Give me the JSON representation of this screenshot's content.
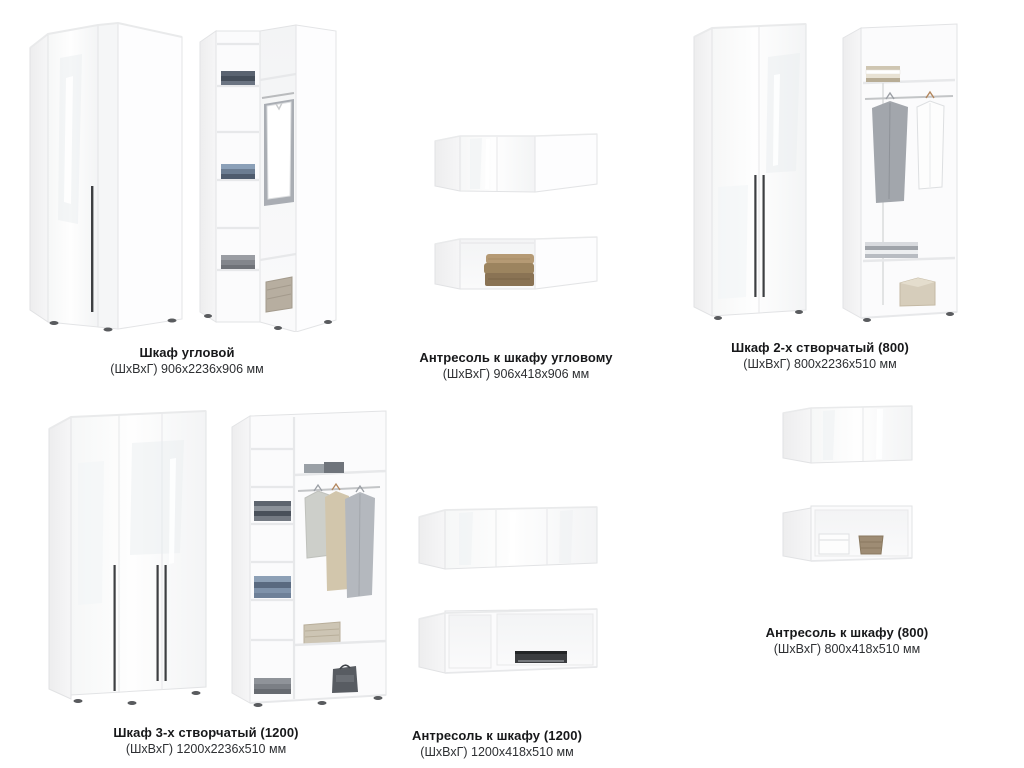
{
  "page": {
    "type": "furniture-catalog-sheet",
    "background_color": "#ffffff",
    "text_color": "#17181a",
    "furniture_color": "#ffffff",
    "handle_color": "#3d3f42"
  },
  "products": [
    {
      "title": "Шкаф угловой",
      "dimensions": "(ШхВхГ) 906х2236х906 мм"
    },
    {
      "title": "Антресоль к шкафу угловому",
      "dimensions": "(ШхВхГ) 906х418х906 мм"
    },
    {
      "title": "Шкаф 2-х створчатый (800)",
      "dimensions": "(ШхВхГ) 800х2236х510 мм"
    },
    {
      "title": "Шкаф 3-х створчатый (1200)",
      "dimensions": "(ШхВхГ) 1200х2236х510 мм"
    },
    {
      "title": "Антресоль к шкафу (1200)",
      "dimensions": "(ШхВхГ) 1200х418х510 мм"
    },
    {
      "title": "Антресоль к шкафу (800)",
      "dimensions": "(ШхВхГ) 800х418х510 мм"
    }
  ]
}
